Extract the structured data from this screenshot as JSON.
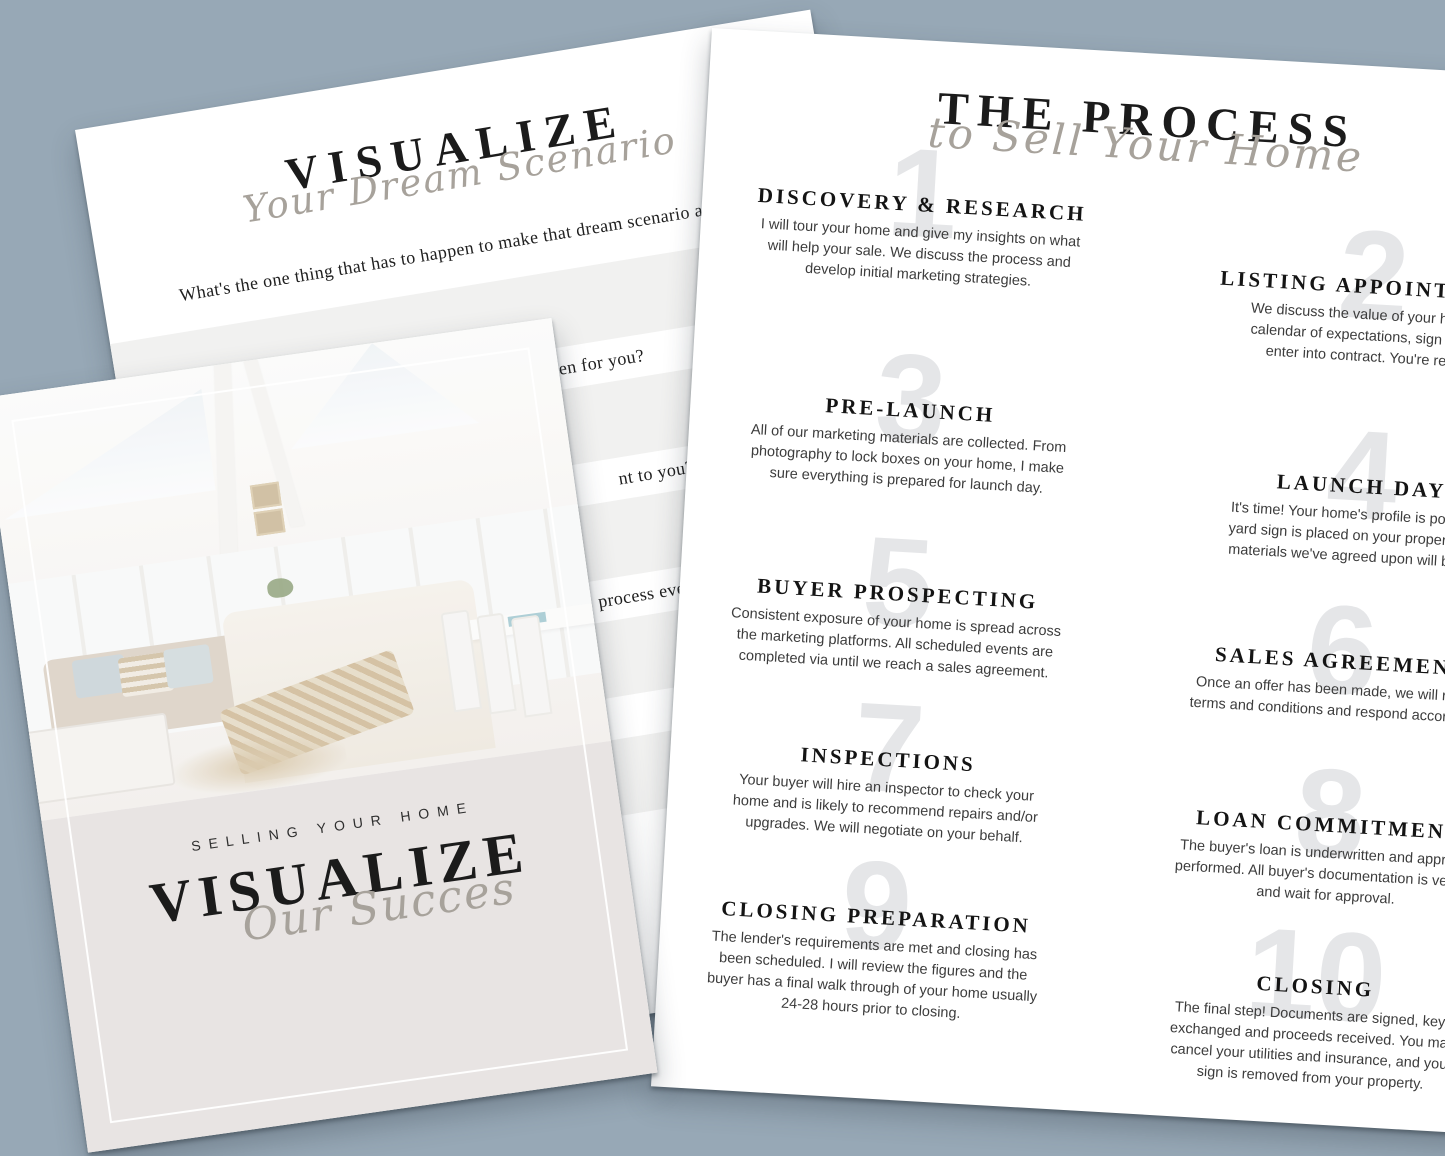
{
  "colors": {
    "bg": "#97a8b6",
    "paper": "#ffffff",
    "beige": "#e8e4e3",
    "stripe": "#f1f1f0",
    "ink": "#1b1b1b",
    "body-ink": "#3c3c3c",
    "script": "#a7a29b",
    "ghost": "#e5e6e8"
  },
  "visualize_page": {
    "title": "VISUALIZE",
    "subtitle_script": "Your Dream Scenario",
    "question": "What's the one thing that has to happen to make that dream scenario a reality?",
    "partial_questions": [
      "ppen for you?",
      "nt to you?",
      "process even better, wha",
      "t to you?"
    ]
  },
  "process_page": {
    "title": "THE PROCESS",
    "subtitle_script": "to Sell Your Home",
    "steps": [
      {
        "number": "1",
        "heading": "DISCOVERY & RESEARCH",
        "body": "I will tour your home and give my insights on what\nwill help your sale. We discuss the process and\ndevelop initial marketing strategies."
      },
      {
        "number": "2",
        "heading": "LISTING APPOINTMENT",
        "body": "We discuss the value of your home, a\ncalendar of expectations, sign off and\nenter into contract. You're ready."
      },
      {
        "number": "3",
        "heading": "PRE-LAUNCH",
        "body": "All of our marketing materials are collected. From\nphotography to lock boxes on your home, I make\nsure everything is prepared for launch day."
      },
      {
        "number": "4",
        "heading": "LAUNCH DAY",
        "body": "It's time! Your home's profile is posted, a\nyard sign is placed on your property, and\nmaterials we've agreed upon will be live."
      },
      {
        "number": "5",
        "heading": "BUYER PROSPECTING",
        "body": "Consistent exposure of your home is spread across\nthe marketing platforms. All scheduled events are\ncompleted via until we reach a sales agreement."
      },
      {
        "number": "6",
        "heading": "SALES AGREEMENT",
        "body": "Once an offer has been made, we will review\nterms and conditions and respond accordingly."
      },
      {
        "number": "7",
        "heading": "INSPECTIONS",
        "body": "Your buyer will hire an inspector to check your\nhome and is likely to recommend repairs and/or\nupgrades. We will negotiate on your behalf."
      },
      {
        "number": "8",
        "heading": "LOAN COMMITMENT",
        "body": "The buyer's loan is underwritten and appraisal\nperformed. All buyer's documentation is verified\nand wait for approval."
      },
      {
        "number": "9",
        "heading": "CLOSING PREPARATION",
        "body": "The lender's requirements are met and closing has\nbeen scheduled.  I will review the figures and the\nbuyer has a final walk through of your home usually\n24-28 hours prior to closing."
      },
      {
        "number": "10",
        "heading": "CLOSING",
        "body": "The final step! Documents are signed, keys\nexchanged and proceeds received. You may\ncancel your utilities and insurance, and your\nsign is removed from your property."
      }
    ]
  },
  "cover_page": {
    "eyebrow": "SELLING YOUR HOME",
    "title": "VISUALIZE",
    "subtitle_script": "Our Succes"
  }
}
